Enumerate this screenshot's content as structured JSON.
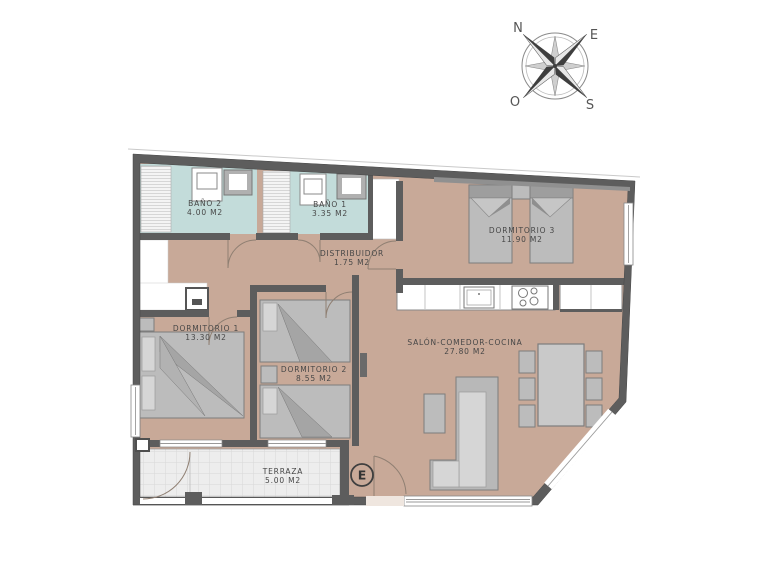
{
  "compass": {
    "north": "N",
    "east": "E",
    "west": "O",
    "south": "S"
  },
  "rooms": [
    {
      "id": "bano-2",
      "name": "BAÑO 2",
      "area": "4.00 M2"
    },
    {
      "id": "bano-1",
      "name": "BAÑO 1",
      "area": "3.35 M2"
    },
    {
      "id": "distribuidor",
      "name": "DISTRIBUIDOR",
      "area": "1.75 M2"
    },
    {
      "id": "dormitorio-3",
      "name": "DORMITORIO 3",
      "area": "11.90 M2"
    },
    {
      "id": "dormitorio-1",
      "name": "DORMITORIO 1",
      "area": "13.30 M2"
    },
    {
      "id": "dormitorio-2",
      "name": "DORMITORIO 2",
      "area": "8.55 M2"
    },
    {
      "id": "salon-comedor-cocina",
      "name": "SALÓN-COMEDOR-COCINA",
      "area": "27.80 M2"
    },
    {
      "id": "terraza",
      "name": "TERRAZA",
      "area": "5.00 M2"
    }
  ],
  "markers": {
    "entrance_label": "E"
  },
  "colors": {
    "wall": "#5d5d5d",
    "floor": "#c8a998",
    "bathroom_floor": "#c3dcda",
    "terrace_floor": "#ededed",
    "furniture": "#bcbcbc",
    "label_text": "#474747"
  }
}
